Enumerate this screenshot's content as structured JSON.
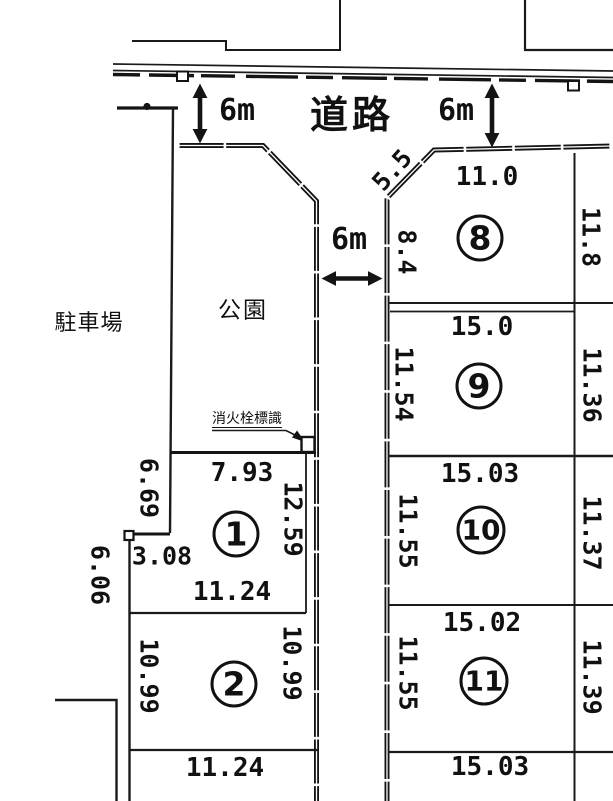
{
  "areas": {
    "road": "道路",
    "park": "公園",
    "parking": "駐車場",
    "fire_hydrant_sign": "消火栓標識"
  },
  "road_widths": {
    "left": "6m",
    "right": "6m",
    "center": "6m"
  },
  "plots": [
    {
      "number": "1",
      "dimensions": {
        "top": "7.93",
        "upper_left": "6.69",
        "lower_left": "3.08",
        "right": "12.59",
        "bottom": "11.24"
      }
    },
    {
      "number": "2",
      "dimensions": {
        "top": "11.24",
        "left": "10.99",
        "right": "10.99",
        "bottom": "11.24"
      }
    },
    {
      "number": "8",
      "dimensions": {
        "top": "11.0",
        "corner_chamfer": "5.5",
        "left": "8.4",
        "right": "11.8",
        "bottom": "15.0"
      }
    },
    {
      "number": "9",
      "dimensions": {
        "top": "15.0",
        "left": "11.54",
        "right": "11.36",
        "bottom": "15.03"
      }
    },
    {
      "number": "10",
      "dimensions": {
        "top": "15.03",
        "left": "11.55",
        "right": "11.37",
        "bottom": "15.02"
      }
    },
    {
      "number": "11",
      "dimensions": {
        "top": "15.02",
        "left": "11.55",
        "right": "11.39",
        "bottom": "15.03"
      }
    }
  ],
  "other_dimensions": {
    "parking_edge": "6.06"
  },
  "labels": [
    {
      "name": "dim-6m-left",
      "text": "6m",
      "x": 237,
      "y": 111,
      "size": 30
    },
    {
      "name": "dim-6m-right",
      "text": "6m",
      "x": 456,
      "y": 111,
      "size": 30
    },
    {
      "name": "dim-6m-center",
      "text": "6m",
      "x": 349,
      "y": 240,
      "size": 30
    },
    {
      "name": "dim-chamfer-5-5",
      "text": "5.5",
      "x": 392,
      "y": 170,
      "size": 25,
      "rot": -48
    },
    {
      "name": "dim-plot8-top",
      "text": "11.0",
      "x": 487,
      "y": 177,
      "size": 26
    },
    {
      "name": "dim-plot8-left",
      "text": "8.4",
      "x": 407,
      "y": 252,
      "size": 25,
      "rot": 90
    },
    {
      "name": "dim-plot8-right",
      "text": "11.8",
      "x": 591,
      "y": 237,
      "size": 25,
      "rot": 90
    },
    {
      "name": "dim-plot9-top",
      "text": "15.0",
      "x": 482,
      "y": 327,
      "size": 26
    },
    {
      "name": "dim-plot9-left",
      "text": "11.54",
      "x": 404,
      "y": 384,
      "size": 25,
      "rot": 90
    },
    {
      "name": "dim-plot9-right",
      "text": "11.36",
      "x": 592,
      "y": 385,
      "size": 25,
      "rot": 90
    },
    {
      "name": "dim-plot10-top",
      "text": "15.03",
      "x": 480,
      "y": 474,
      "size": 26
    },
    {
      "name": "dim-plot10-left",
      "text": "11.55",
      "x": 408,
      "y": 531,
      "size": 25,
      "rot": 90
    },
    {
      "name": "dim-plot10-right",
      "text": "11.37",
      "x": 592,
      "y": 533,
      "size": 25,
      "rot": 90
    },
    {
      "name": "dim-plot11-top",
      "text": "15.02",
      "x": 482,
      "y": 623,
      "size": 26
    },
    {
      "name": "dim-plot11-left",
      "text": "11.55",
      "x": 408,
      "y": 673,
      "size": 25,
      "rot": 90
    },
    {
      "name": "dim-plot11-right",
      "text": "11.39",
      "x": 592,
      "y": 677,
      "size": 25,
      "rot": 90
    },
    {
      "name": "dim-plot11-bottom",
      "text": "15.03",
      "x": 490,
      "y": 767,
      "size": 26
    },
    {
      "name": "dim-plot1-top",
      "text": "7.93",
      "x": 242,
      "y": 473,
      "size": 26
    },
    {
      "name": "dim-plot1-upper-left",
      "text": "6.69",
      "x": 149,
      "y": 488,
      "size": 25,
      "rot": 90
    },
    {
      "name": "dim-plot1-right",
      "text": "12.59",
      "x": 293,
      "y": 519,
      "size": 25,
      "rot": 90
    },
    {
      "name": "dim-plot1-lower-left",
      "text": "3.08",
      "x": 162,
      "y": 556,
      "size": 25
    },
    {
      "name": "dim-parking-edge",
      "text": "6.06",
      "x": 100,
      "y": 575,
      "size": 25,
      "rot": 90
    },
    {
      "name": "dim-plot1-bottom",
      "text": "11.24",
      "x": 232,
      "y": 592,
      "size": 26
    },
    {
      "name": "dim-plot2-left",
      "text": "10.99",
      "x": 149,
      "y": 676,
      "size": 25,
      "rot": 90
    },
    {
      "name": "dim-plot2-right",
      "text": "10.99",
      "x": 292,
      "y": 663,
      "size": 25,
      "rot": 90
    },
    {
      "name": "dim-plot2-bottom",
      "text": "11.24",
      "x": 225,
      "y": 768,
      "size": 26
    }
  ],
  "plot_numbers": [
    {
      "text": "1",
      "x": 236,
      "y": 534
    },
    {
      "text": "2",
      "x": 234,
      "y": 684
    },
    {
      "text": "8",
      "x": 480,
      "y": 238
    },
    {
      "text": "9",
      "x": 479,
      "y": 386
    },
    {
      "text": "10",
      "x": 481,
      "y": 530
    },
    {
      "text": "11",
      "x": 484,
      "y": 681
    }
  ]
}
